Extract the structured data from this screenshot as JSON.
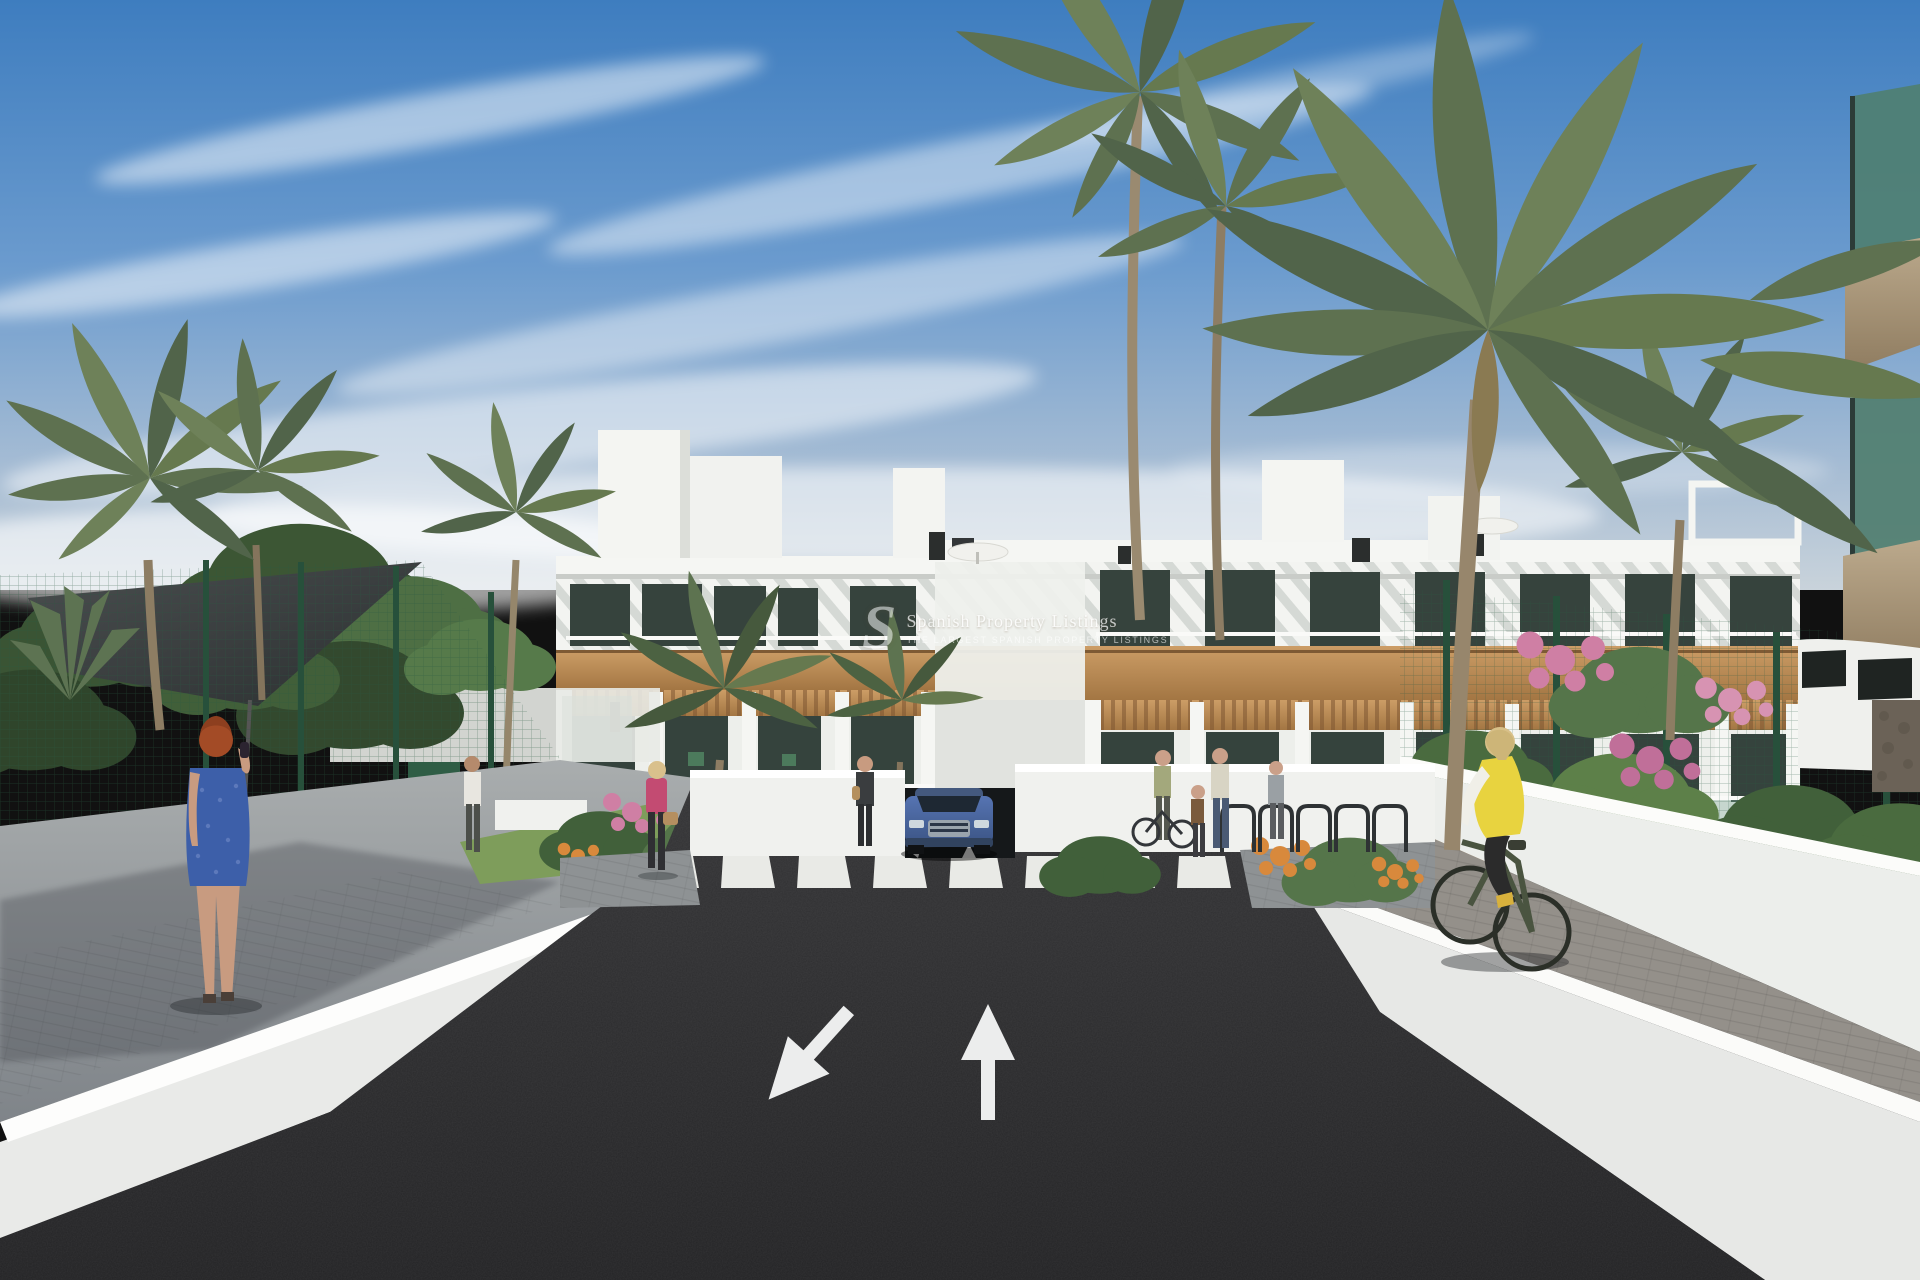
{
  "watermark": {
    "logo_letter": "S",
    "title": "Spanish Property Listings",
    "tagline": "THE LARGEST SPANISH PROPERTY LISTINGS"
  },
  "road_markings": {
    "left_arrow_direction": "down-left",
    "right_arrow_direction": "straight-ahead",
    "crosswalk_stripes": 8
  },
  "palette": {
    "sky_top": "#3e7dbf",
    "sky_horizon": "#c9d3db",
    "cloud_white": "#ffffff",
    "building_white": "#f3f4f1",
    "wood_cladding": "#b98a57",
    "window_dark": "#36433d",
    "glass_teal": "#557f72",
    "road_asphalt": "#2a2a2c",
    "wall_white": "#eceeea",
    "wall_top_white": "#fdfdfb",
    "walkway_gray": "#8f959a",
    "paver_gray": "#8f8b84",
    "fence_green": "#2e5c44",
    "foliage_green": "#53704a",
    "palm_green": "#66794f",
    "lawn_green": "#7a9a58",
    "flower_pink": "#cf7fa4",
    "flower_orange": "#d8893c",
    "car_blue": "#4a67a3",
    "cyclist_vest_yellow": "#e8d33f",
    "jacket_pink": "#c34b72",
    "dress_blue": "#3d5fa9",
    "hair_red": "#a34b26",
    "marking_white": "#e9eae6"
  }
}
